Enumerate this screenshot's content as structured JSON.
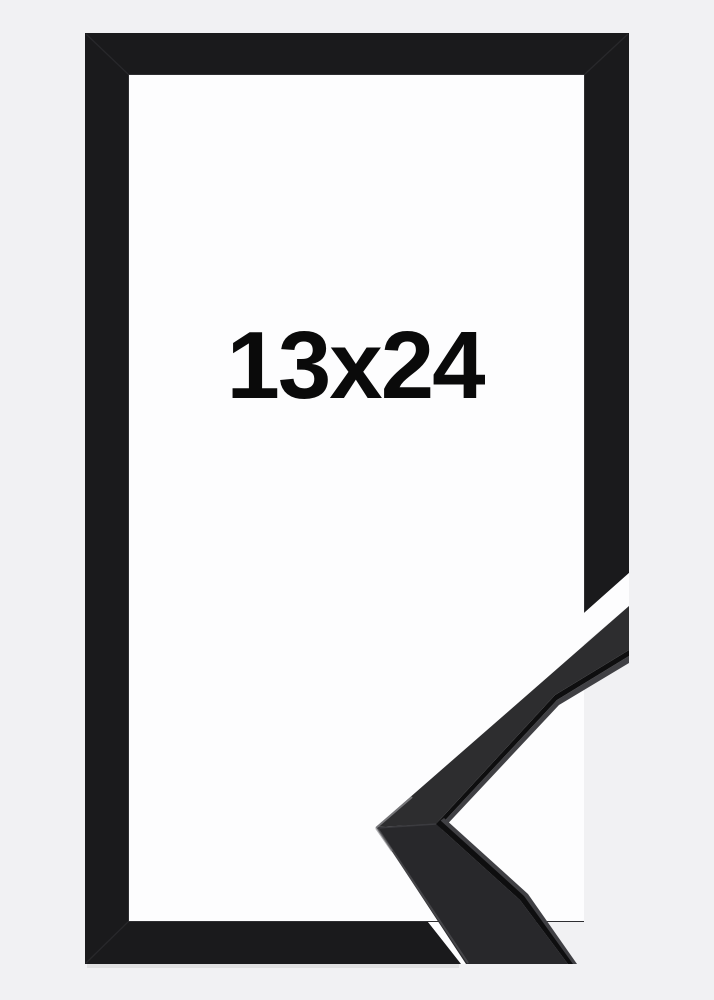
{
  "product": {
    "size_label": "13x24"
  },
  "colors": {
    "background": "#f1f1f3",
    "window": "#fdfdfe",
    "cutout_white": "#fdfdfe",
    "frame": "#1a1a1c",
    "frame_seam": "#28282b",
    "frame_lip": "#2e2e31",
    "shadow": "#000000",
    "moulding_upper": "#2d2d2f",
    "moulding_lower": "#28282b",
    "moulding_edge": "#0e0e0f",
    "moulding_sheen": "#404044",
    "moulding_bevel": "#4a4a4e",
    "moulding_tip": "#7e7e82",
    "moulding_seam": "#3c3c40",
    "label": "#0a0a0a"
  }
}
